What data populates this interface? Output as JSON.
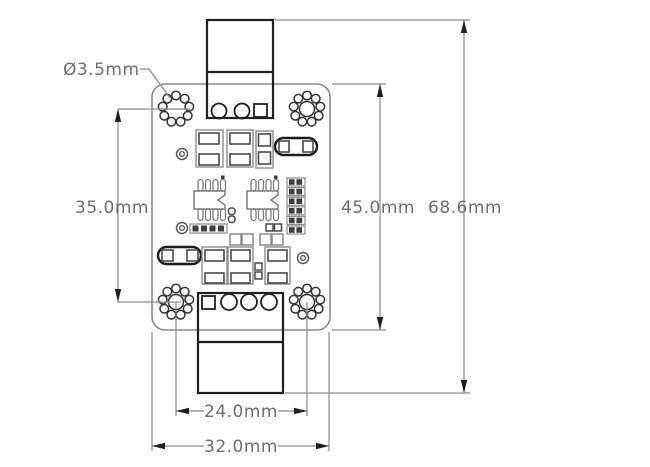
{
  "drawing": {
    "units": "mm",
    "dimensions": {
      "hole_diameter": "Ø3.5mm",
      "hole_pitch_vertical": "35.0mm",
      "board_height": "45.0mm",
      "overall_height": "68.6mm",
      "hole_pitch_horizontal": "24.0mm",
      "board_width": "32.0mm"
    },
    "colors": {
      "line_gray": "#8b8b8b",
      "line_dark": "#1f1f1f",
      "pad_fill": "#3f3f3f",
      "dimension_text": "#6e6e6e",
      "background": "#ffffff"
    }
  }
}
